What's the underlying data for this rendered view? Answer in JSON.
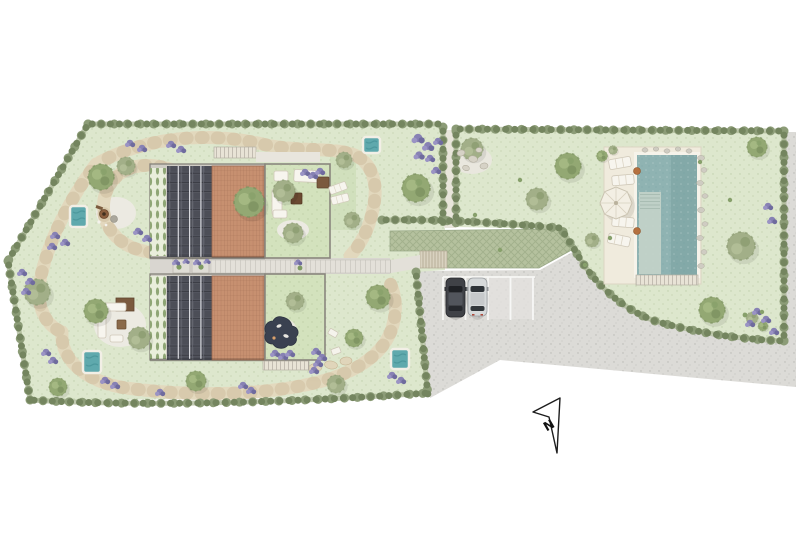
{
  "scene": {
    "type": "architectural-site-plan",
    "description": "Top-view landscape site plan: two semi-detached houses with solar-panel and clay-tile roofs, walled courtyards, hedged gardens with stone paths and plunge pools, a large swimming pool with sun deck, gravel driveway with parking bays and two cars, north arrow"
  },
  "compass": {
    "label": "N"
  },
  "palette": {
    "background": "#ffffff",
    "lawn": "#dde7cd",
    "courtyard_lawn": "#d3e2bd",
    "gravel": "#dcdbd7",
    "stone_path": "#e3d8bd",
    "hedge": "#8c9c77",
    "solar_roof": "#4c4e57",
    "tile_roof": "#c79070",
    "deck": "#f0ebdd",
    "pool_water": "#8fb3b2",
    "plunge_pool": "#5fa9ad",
    "grass_pavers": "#b5c19e",
    "car_dark": "#404247",
    "car_silver": "#d6d9da",
    "tree_green": "#93a873",
    "lavender": "#8781b4",
    "north_arrow_stroke": "#1c1c1c"
  },
  "inventory": {
    "semi_detached_houses": 2,
    "solar_panel_roofs": 2,
    "tiled_roofs": 2,
    "walled_courtyards": 2,
    "plunge_pools": 4,
    "main_swimming_pool": 1,
    "pool_sun_loungers": 4,
    "garden_loungers": 4,
    "parasols": 1,
    "parked_cars": 2,
    "parking_bays": 4,
    "surfaces": "gravel driveway, flagstone paths, grass pavers",
    "boundary": "hedgerows with trees and lavender"
  }
}
